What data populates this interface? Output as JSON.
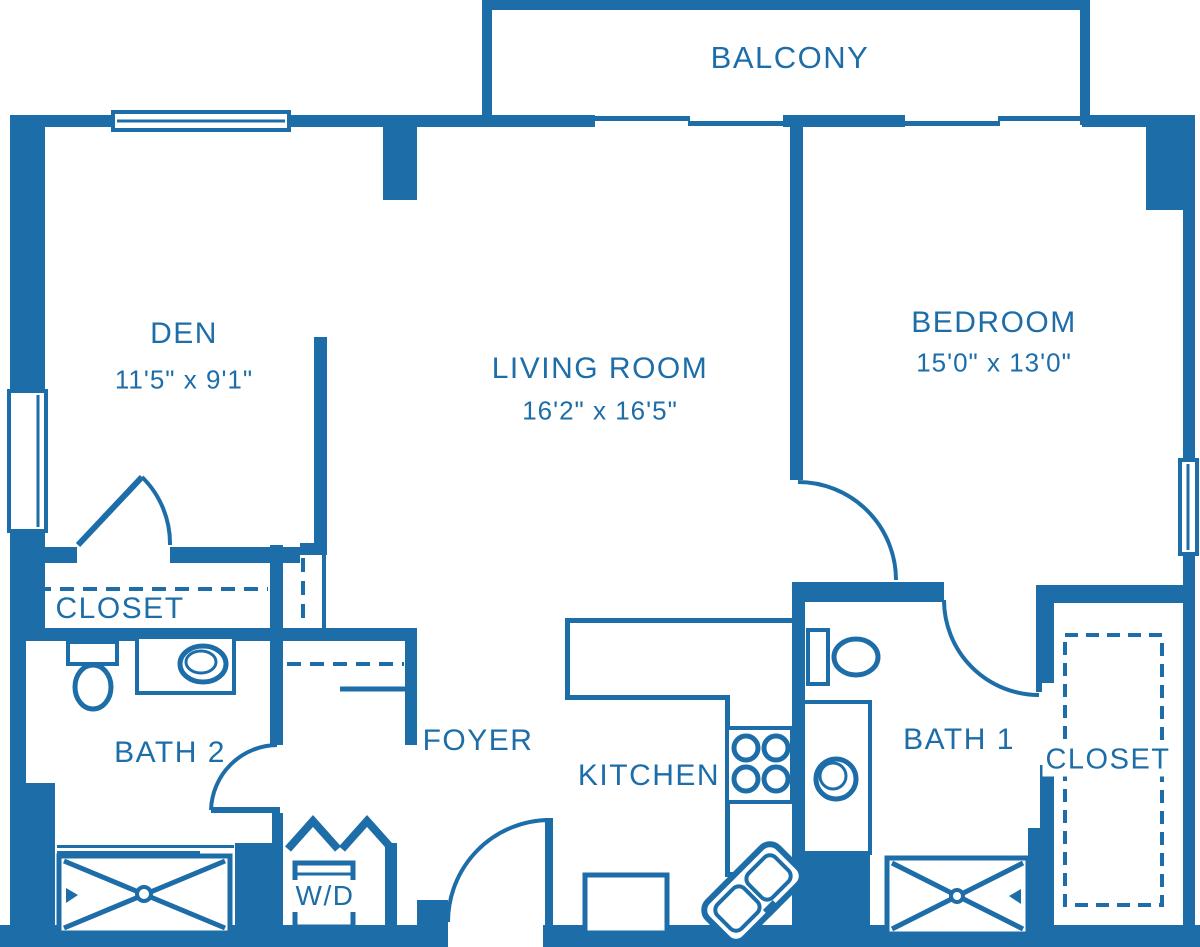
{
  "plan": {
    "accent_color": "#1d6da8",
    "background_color": "#ffffff",
    "rooms": {
      "balcony": {
        "name": "BALCONY"
      },
      "den": {
        "name": "DEN",
        "dims": "11'5\" x 9'1\""
      },
      "living": {
        "name": "LIVING ROOM",
        "dims": "16'2\" x 16'5\""
      },
      "bedroom": {
        "name": "BEDROOM",
        "dims": "15'0\" x 13'0\""
      },
      "closet_left": {
        "name": "CLOSET"
      },
      "bath2": {
        "name": "BATH 2"
      },
      "foyer": {
        "name": "FOYER"
      },
      "kitchen": {
        "name": "KITCHEN"
      },
      "bath1": {
        "name": "BATH 1"
      },
      "closet_right": {
        "name": "CLOSET"
      },
      "washer_dryer": {
        "name": "W/D"
      }
    },
    "icons": {
      "bathtub": "rect-with-x-cross",
      "toilet": "tank-and-oval-bowl",
      "vanity_sink": "oval-in-counter",
      "stove": "four-burner-circles",
      "kitchen_sink": "angled-double-basin",
      "closet_rod": "dashed-line",
      "door": "quarter-circle-arc",
      "window": "thin-double-line",
      "bifold_door": "zigzag"
    }
  }
}
